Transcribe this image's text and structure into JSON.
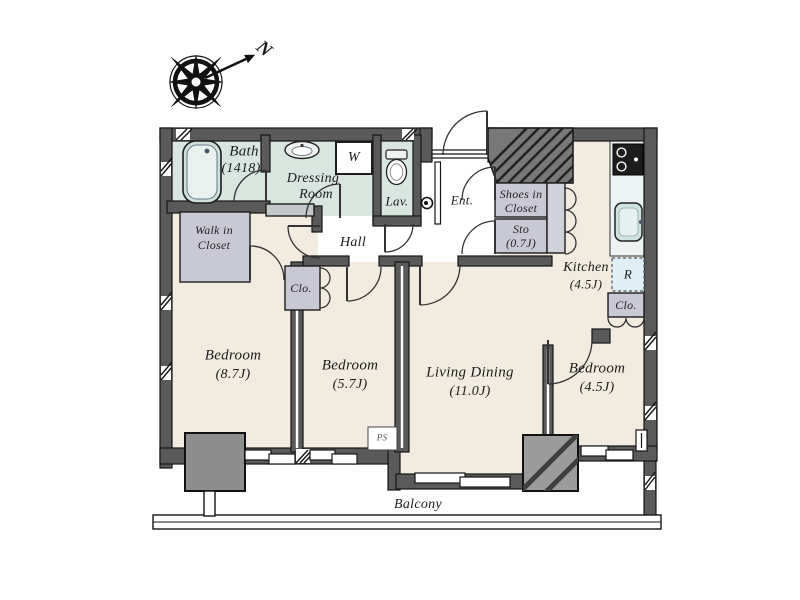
{
  "compass": {
    "north_label": "N"
  },
  "rooms": {
    "bath": {
      "name": "Bath",
      "size": "(1418)"
    },
    "dressing_room": {
      "line1": "Dressing",
      "line2": "Room"
    },
    "washer": {
      "label": "W"
    },
    "lavatory": {
      "label": "Lav."
    },
    "entrance": {
      "label": "Ent."
    },
    "shoes_in_closet": {
      "line1": "Shoes in",
      "line2": "Closet"
    },
    "storage": {
      "line1": "Sto",
      "line2": "(0.7J)"
    },
    "kitchen": {
      "name": "Kitchen",
      "size": "(4.5J)"
    },
    "refrigerator": {
      "label": "R"
    },
    "walk_in_closet": {
      "line1": "Walk in",
      "line2": "Closet"
    },
    "hall": {
      "label": "Hall"
    },
    "closet_bedroom2": {
      "label": "Clo."
    },
    "closet_bedroom3": {
      "label": "Clo."
    },
    "bedroom1": {
      "name": "Bedroom",
      "size": "(8.7J)"
    },
    "bedroom2": {
      "name": "Bedroom",
      "size": "(5.7J)"
    },
    "living_dining": {
      "name": "Living Dining",
      "size": "(11.0J)"
    },
    "bedroom3": {
      "name": "Bedroom",
      "size": "(4.5J)"
    },
    "pipe_space": {
      "label": "PS"
    },
    "balcony": {
      "label": "Balcony"
    }
  },
  "colors": {
    "wall": "#5a5a5a",
    "floor": "#f1ecdf",
    "wet_area": "#d9e5df",
    "closet": "#c9c9d6",
    "counter": "#edf3f2",
    "refrigerator_box": "#e0eff3",
    "pillar": "#8e8e8e",
    "outline": "#141414"
  }
}
